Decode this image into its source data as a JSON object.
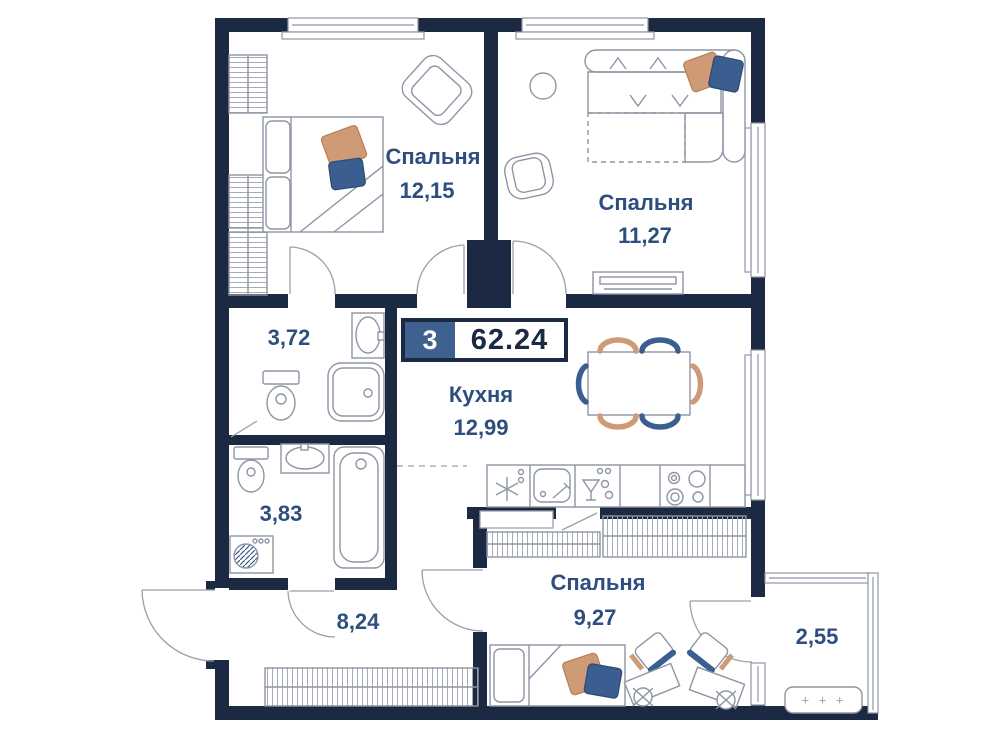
{
  "badge": {
    "rooms_count": "3",
    "total_area": "62.24"
  },
  "rooms": {
    "bedroom1": {
      "name": "Спальня",
      "area": "12,15"
    },
    "bedroom2": {
      "name": "Спальня",
      "area": "11,27"
    },
    "kitchen": {
      "name": "Кухня",
      "area": "12,99"
    },
    "bathroom1": {
      "area": "3,72"
    },
    "bathroom2": {
      "area": "3,83"
    },
    "hallway": {
      "area": "8,24"
    },
    "bedroom3": {
      "name": "Спальня",
      "area": "9,27"
    },
    "balcony": {
      "area": "2,55"
    }
  },
  "balcony_planter": {
    "symbols": "+ + +"
  },
  "colors": {
    "wall": "#1b2942",
    "room_label": "#2d4e7e",
    "badge_number_bg": "#3e6190",
    "accent_orange": "#cf9b76",
    "accent_blue": "#3b5e90",
    "furniture_stroke": "#8e95a3"
  }
}
